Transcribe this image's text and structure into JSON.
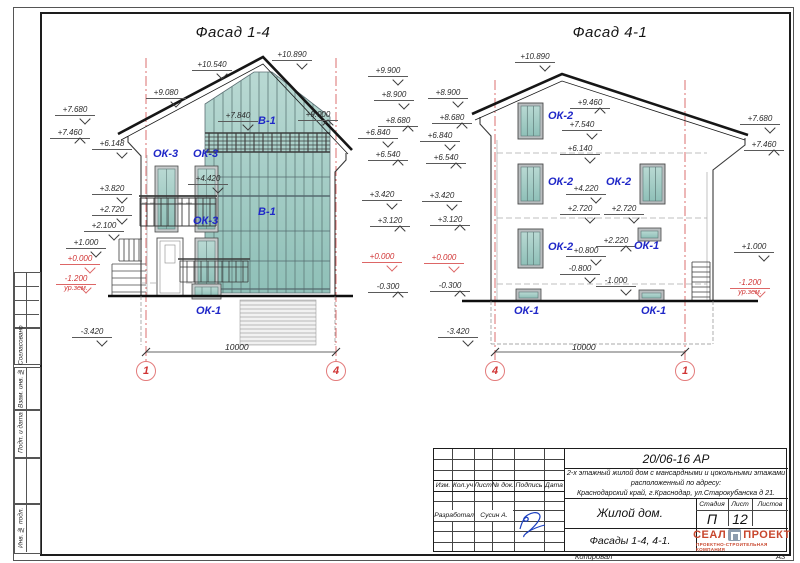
{
  "sheet": {
    "format": "А3",
    "copied": "Копировал"
  },
  "margin_labels": {
    "agreed": "Согласовано",
    "replace_inv": "Взам. инв. №",
    "sign_date": "Подп. и дата",
    "inv_orig": "Инв. № подл."
  },
  "facade_14": {
    "title": "Фасад 1-4",
    "elevations": [
      "+7.680",
      "+7.460",
      "+6.148",
      "+3.820",
      "+2.720",
      "+2.100",
      "+1.000",
      "+0.000",
      "-1.200",
      "-3.420",
      "+10.540",
      "+10.890",
      "+9.080",
      "+7.840",
      "+9.000",
      "+4.420",
      "+9.900",
      "+8.900",
      "+8.680",
      "+6.840",
      "+6.540",
      "+3.420",
      "+3.120",
      "+0.000",
      "-0.300"
    ],
    "ground_level_note": "ур.зем.",
    "window_labels": [
      "В-1",
      "ОК-3",
      "ОК-3",
      "В-1",
      "ОК-3",
      "ОК-1"
    ],
    "dimension": "10000",
    "axis_left": "1",
    "axis_right": "4"
  },
  "facade_41": {
    "title": "Фасад 4-1",
    "elevations": [
      "+8.900",
      "+8.680",
      "+6.840",
      "+6.540",
      "+3.420",
      "+3.120",
      "+0.000",
      "-0.300",
      "-3.420",
      "+10.890",
      "+9.460",
      "+7.540",
      "+6.140",
      "+4.220",
      "+2.720",
      "+2.720",
      "+2.220",
      "+0.800",
      "-0.800",
      "-1.000",
      "+7.680",
      "+7.460",
      "+1.000",
      "-1.200"
    ],
    "ground_level_note": "ур.зем.",
    "window_labels": [
      "ОК-2",
      "ОК-2",
      "ОК-2",
      "ОК-2",
      "ОК-1",
      "ОК-1",
      "ОК-1"
    ],
    "dimension": "10000",
    "axis_left": "4",
    "axis_right": "1"
  },
  "title_block": {
    "document_number": "20/06-16 АР",
    "description_line1": "2-х этажный жилой дом с мансардными и цокольными этажами",
    "description_line2": "расположенный по адресу:",
    "description_line3": "Краснодарский край, г.Краснодар, ул.Старокубанска д 21.",
    "columns": [
      "Изм.",
      "Кол.уч",
      "Лист",
      "№ док.",
      "Подпись",
      "Дата"
    ],
    "developed_label": "Разработал",
    "developer_name": "Сусин А.",
    "object_name": "Жилой дом.",
    "stage_label": "Стадия",
    "sheet_label": "Лист",
    "sheets_label": "Листов",
    "stage": "П",
    "sheet_number": "12",
    "drawing_name": "Фасады 1-4, 4-1.",
    "company": {
      "name_left": "СЕАЛ",
      "name_right": "ПРОЕКТ",
      "tagline": "ПРОЕКТНО-СТРОИТЕЛЬНАЯ КОМПАНИЯ"
    }
  },
  "colors": {
    "axis_red": "#d23b3b",
    "label_blue": "#2028c8",
    "glass_teal": "#9fc7c0",
    "logo_red": "#c8472e"
  }
}
